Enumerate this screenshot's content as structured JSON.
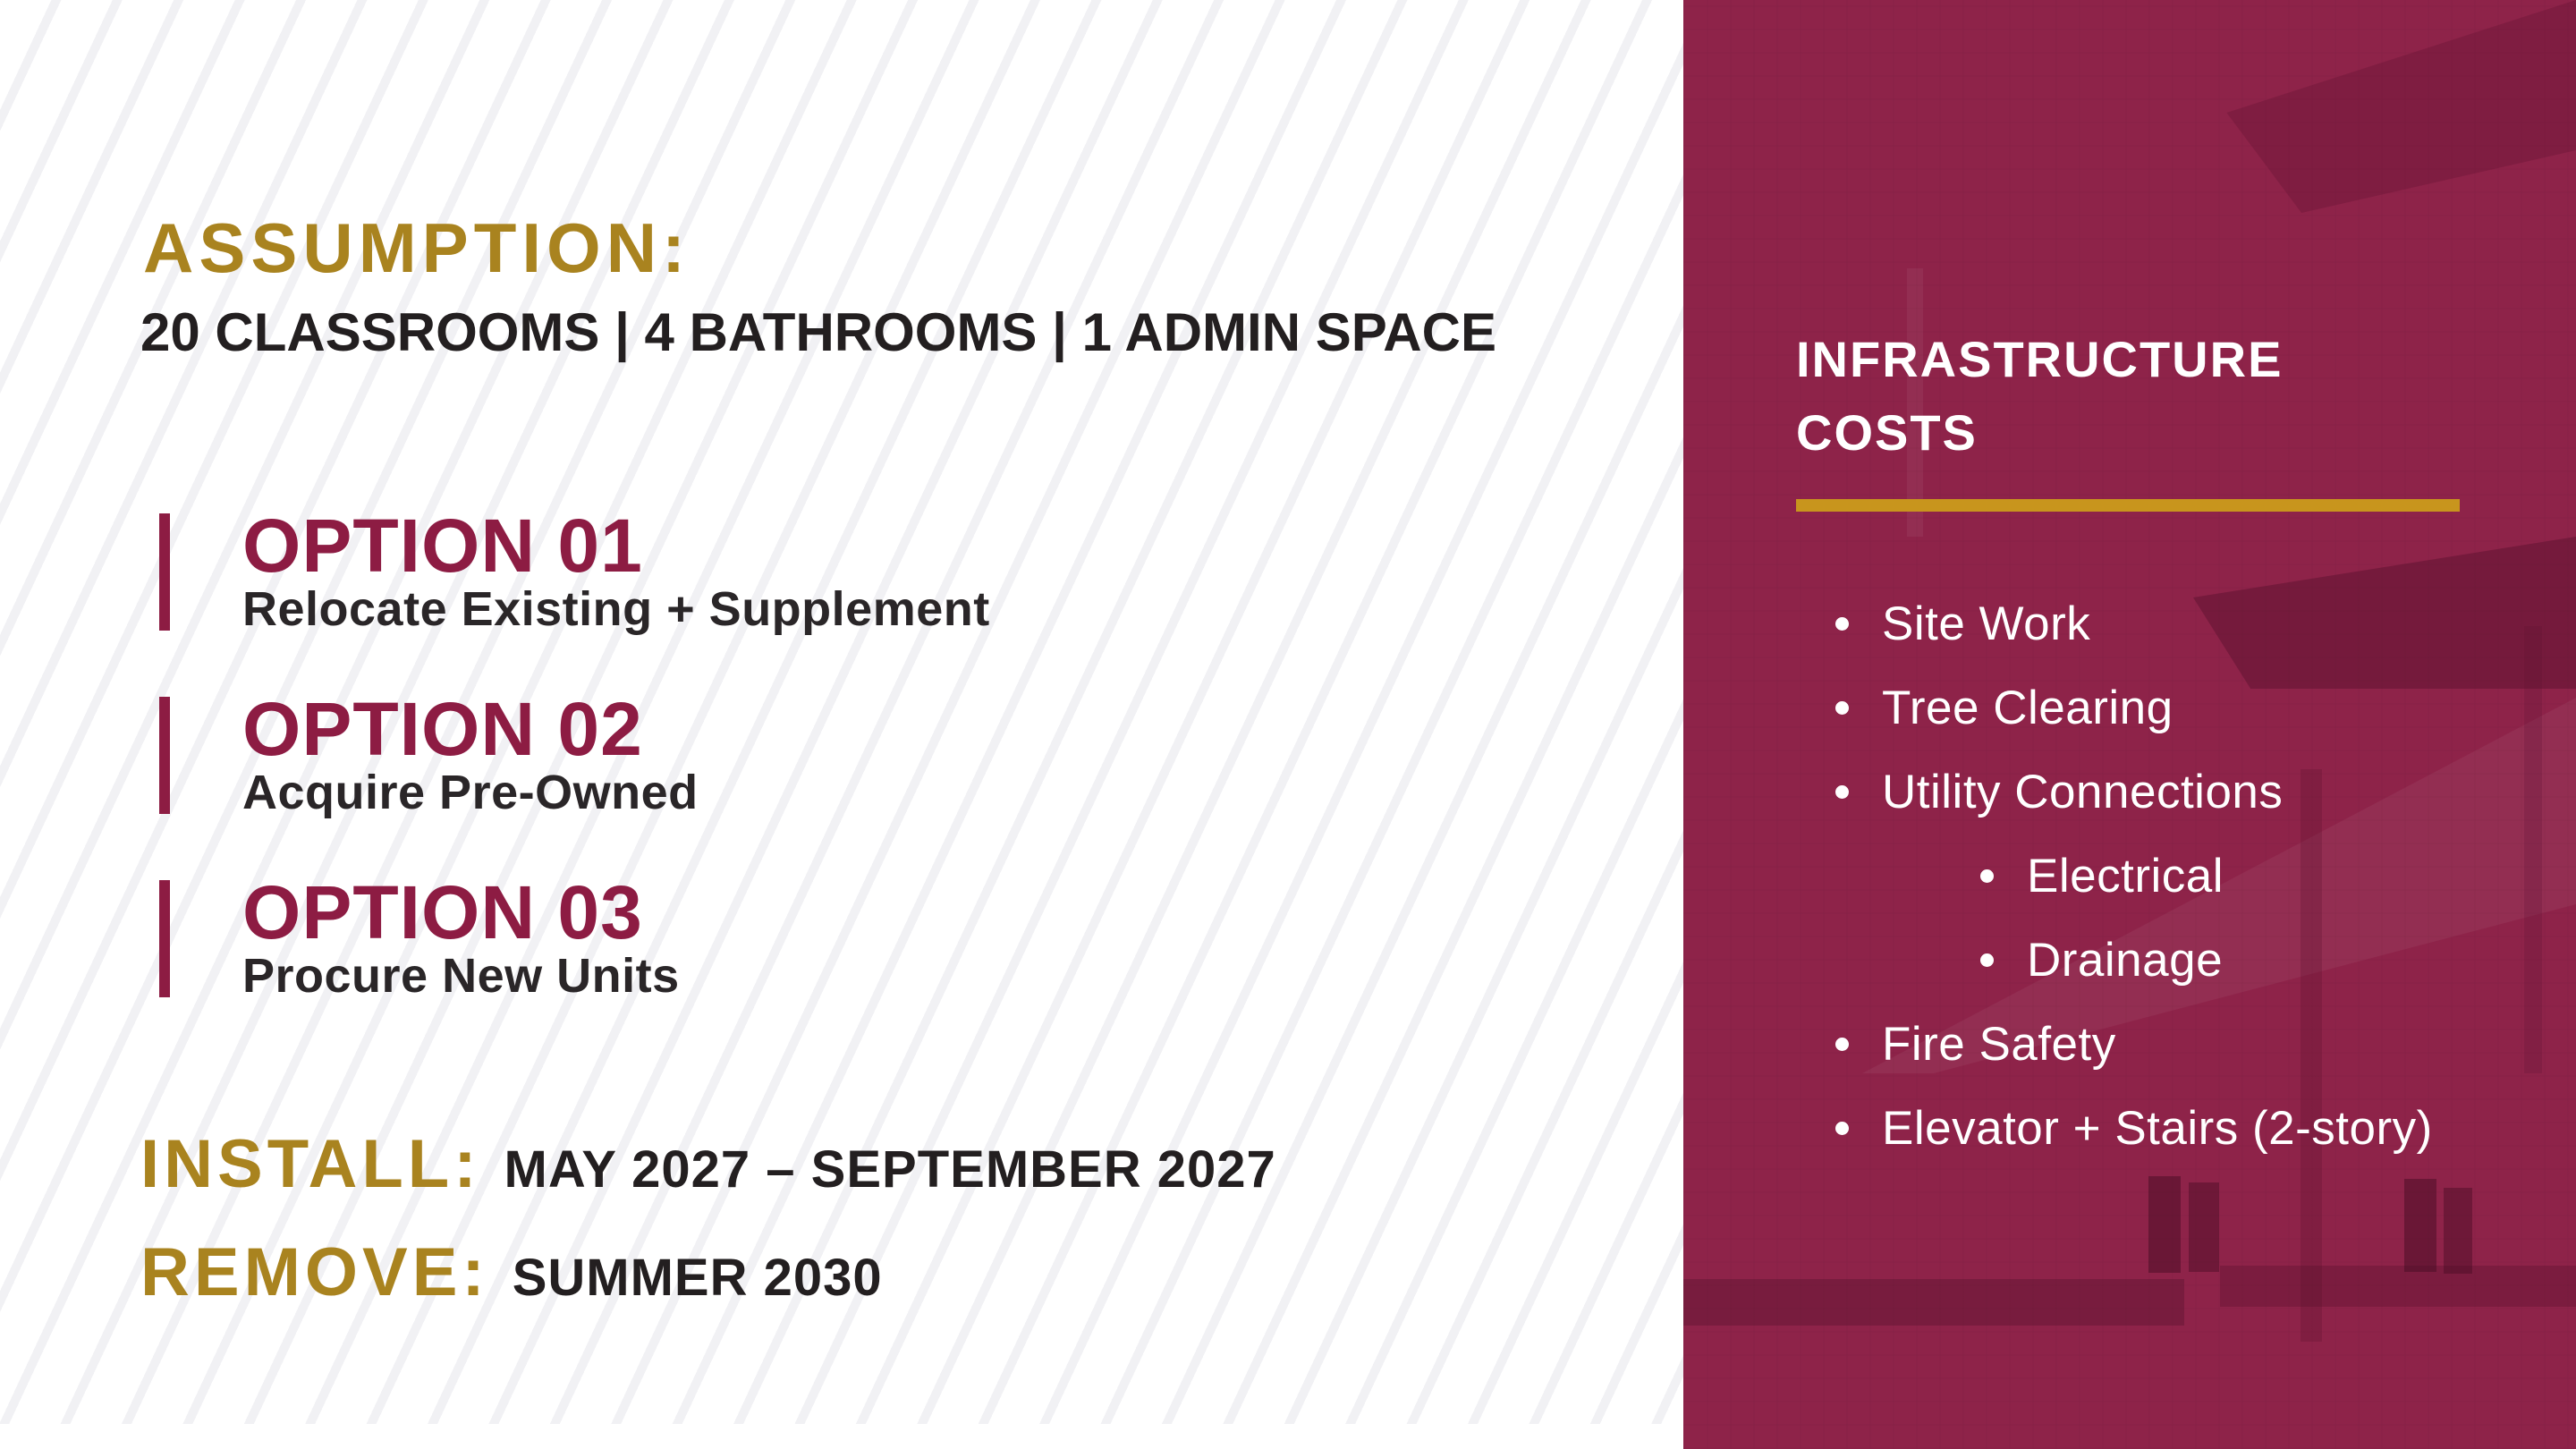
{
  "left": {
    "assumption_label": "ASSUMPTION:",
    "assumption_detail": "20 CLASSROOMS | 4 BATHROOMS | 1 ADMIN SPACE",
    "options": [
      {
        "number": "OPTION 01",
        "description": "Relocate Existing + Supplement"
      },
      {
        "number": "OPTION 02",
        "description": "Acquire Pre-Owned"
      },
      {
        "number": "OPTION 03",
        "description": "Procure New Units"
      }
    ],
    "install_label": "INSTALL:",
    "install_value": "MAY 2027 – SEPTEMBER 2027",
    "remove_label": "REMOVE:",
    "remove_value": "SUMMER 2030"
  },
  "panel": {
    "title_line1": "INFRASTRUCTURE",
    "title_line2": "COSTS",
    "items": [
      {
        "label": "Site Work",
        "level": 1
      },
      {
        "label": "Tree Clearing",
        "level": 1
      },
      {
        "label": "Utility Connections",
        "level": 1
      },
      {
        "label": "Electrical",
        "level": 2
      },
      {
        "label": "Drainage",
        "level": 2
      },
      {
        "label": "Fire Safety",
        "level": 1
      },
      {
        "label": "Elevator + Stairs (2-story)",
        "level": 1
      }
    ]
  },
  "colors": {
    "gold_text": "#A9831F",
    "gold_divider": "#C8951D",
    "maroon_accent": "#8D1C43",
    "panel_background": "#8E2349",
    "dark_text": "#231F20",
    "stripe_gray": "#F1F1F4"
  }
}
